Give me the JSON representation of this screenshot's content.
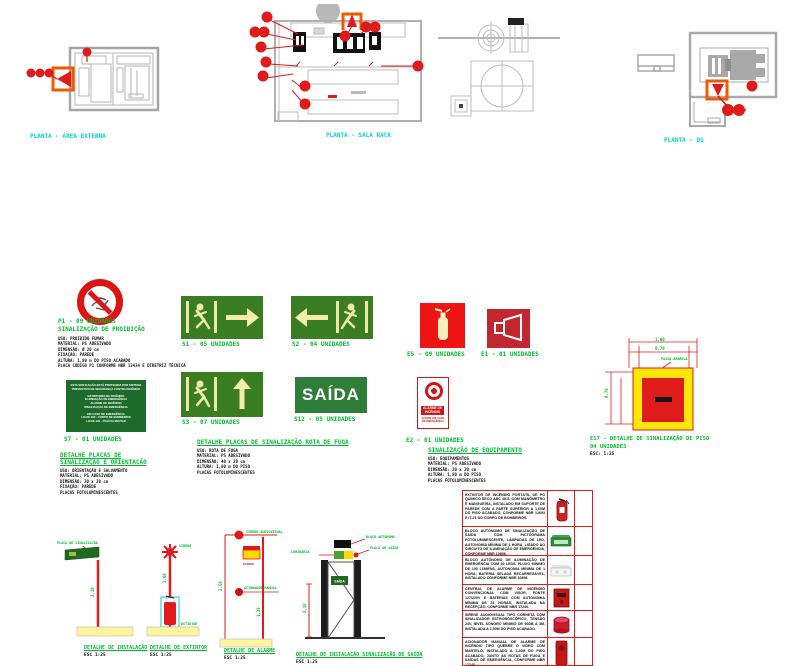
{
  "plans": {
    "left": {
      "label": "PLANTA - ÁREA EXTERNA"
    },
    "center": {
      "label": "PLANTA - SALA RACK"
    },
    "right": {
      "label": "PLANTA - DG"
    }
  },
  "prohibition": {
    "code": "P1 - 09 UNIDADES",
    "title": "SINALIZAÇÃO DE PROIBIÇÃO",
    "specs": [
      "USO: PROIBIDO FUMAR",
      "MATERIAL: PS ADESIVADO",
      "DIMENSÃO: Ø 20 cm",
      "FIXAÇÃO: PAREDE",
      "ALTURA: 1,80 m DO PISO ACABADO",
      "PLACA CÓDIGO P1 CONFORME NBR 13434 E DIRETRIZ TÉCNICA"
    ]
  },
  "signs": {
    "s1": "S1 - 05 UNIDADES",
    "s2": "S2 - 04 UNIDADES",
    "e5": "E5 - 09 UNIDADES",
    "e1": "E1 - 01 UNIDADES",
    "s7": "S7 - 01 UNIDADES",
    "s3": "S3 - 07 UNIDADES",
    "s12": "S12 - 05 UNIDADES",
    "e2": "E2 - 01 UNIDADES",
    "saida_text": "SAÍDA"
  },
  "s7_sign_lines": [
    "ESTA EDIFICAÇÃO ESTÁ PROTEGIDA POR SISTEMA",
    "PREVENTIVO DE SEGURANÇA CONTRA INCÊNDIO",
    "",
    "EXTINTORES DE INCÊNDIO",
    "ILUMINAÇÃO DE EMERGÊNCIA",
    "ALARME DE INCÊNDIO",
    "SINALIZAÇÃO DE EMERGÊNCIA",
    "",
    "EM CASO DE EMERGÊNCIA",
    "LIGUE 193 - CORPO DE BOMBEIROS",
    "LIGUE 190 - POLÍCIA MILITAR"
  ],
  "e2_sign": {
    "band1": "ALARME DE",
    "band2": "INCÊNDIO",
    "sub1": "ACIONE EM CASO",
    "sub2": "DE EMERGÊNCIA"
  },
  "blocks": {
    "orientation": {
      "title1": "DETALHE PLACAS DE",
      "title2": "SINALIZAÇÃO E ORIENTAÇÃO",
      "specs": [
        "USO: ORIENTAÇÃO E SALVAMENTO",
        "MATERIAL: PS ADESIVADO",
        "DIMENSÃO: 30 x 20 cm",
        "FIXAÇÃO: PAREDE",
        "PLACAS FOTOLUMINESCENTES"
      ]
    },
    "escape": {
      "title": "DETALHE PLACAS DE SINALIZAÇÃO ROTA DE FUGA",
      "specs": [
        "USO: ROTA DE FUGA",
        "MATERIAL: PS ADESIVADO",
        "DIMENSÃO: 40 x 20 cm",
        "ALTURA: 1,80 m DO PISO",
        "PLACAS FOTOLUMINESCENTES"
      ]
    },
    "equipment": {
      "title": "SINALIZAÇÃO DE EQUIPAMENTO",
      "specs": [
        "USO: EQUIPAMENTOS",
        "MATERIAL: PS ADESIVADO",
        "DIMENSÃO: 20 x 20 cm",
        "ALTURA: 1,80 m DO PISO",
        "PLACAS FOTOLUMINESCENTES"
      ]
    }
  },
  "e17": {
    "line1": "E17 - DETALHE DE SINALIZAÇÃO DE PISO",
    "line2": "04 UNIDADES",
    "scale": "ESC: 1:25",
    "leader": "FAIXA AMARELA",
    "dim_top": "1,00",
    "dim_top2": "0,70",
    "dim_left": "0,70"
  },
  "details": {
    "d1": {
      "title": "DETALHE DE INSTALAÇÃO",
      "scale": "ESC 1:25",
      "top_label": "PLACA DE SINALIZAÇÃO",
      "dim": "2,10"
    },
    "d2": {
      "title": "DETALHE DE EXTINTOR",
      "scale": "ESC 1:25",
      "top_label": "SIRENE",
      "side_label": "EXTINTOR",
      "dim": "1,60"
    },
    "d3": {
      "title": "DETALHE DE ALARME",
      "scale": "ESC 1:25",
      "top_label": "SIRENE AUDIOVISUAL",
      "mid_label": "STROBO",
      "low_label": "ACIONADOR MANUAL",
      "dim1": "2,50",
      "dim2": "1,20"
    },
    "d4": {
      "title": "DETALHE DE INSTALAÇÃO SINALIZAÇÃO DE SAÍDA",
      "scale": "ESC 1:25",
      "label_r1": "BLOCO AUTÔNOMO",
      "label_r2": "PLACA DE SAÍDA",
      "label_l": "LUMINÁRIA",
      "mini_sign": "SAÍDA",
      "dim": "2,10"
    }
  },
  "table": {
    "rows": [
      {
        "icon": "fire-extinguisher",
        "qty": "",
        "text": "EXTINTOR DE INCÊNDIO PORTÁTIL DE PÓ QUÍMICO SECO ABC 4KG, COM MANÔMETRO E MANGUEIRA, INSTALADO EM SUPORTE DE PAREDE COM A PARTE SUPERIOR A 1,60M DO PISO ACABADO, CONFORME NBR 12693 E IT-21 DO CORPO DE BOMBEIROS."
      },
      {
        "icon": "exit-luminaire",
        "qty": "",
        "text": "BLOCO AUTÔNOMO DE SINALIZAÇÃO DE SAÍDA COM PICTOGRAMA FOTOLUMINESCENTE, LÂMPADAS DE LED, AUTONOMIA MÍNIMA DE 1 HORA, LIGADO AO CIRCUITO DE ILUMINAÇÃO DE EMERGÊNCIA, CONFORME NBR 10898."
      },
      {
        "icon": "emergency-light",
        "qty": "",
        "text": "BLOCO AUTÔNOMO DE ILUMINAÇÃO DE EMERGÊNCIA COM 30 LEDS, FLUXO MÍNIMO DE 100 LÚMENS, AUTONOMIA MÍNIMA DE 1 HORA, BATERIA SELADA RECARREGÁVEL, INSTALADO CONFORME NBR 10898."
      },
      {
        "icon": "alarm-panel",
        "qty": "",
        "text": "CENTRAL DE ALARME DE INCÊNDIO CONVENCIONAL COM VISOR, FONTE 127/220V E BATERIAS COM AUTONOMIA MÍNIMA DE 24 HORAS, INSTALADA NA RECEPÇÃO, CONFORME NBR 17240."
      },
      {
        "icon": "siren",
        "qty": "",
        "text": "SIRENE AUDIOVISUAL TIPO CORNETA COM SINALIZADOR ESTROBOSCÓPICO, TENSÃO 24V, NÍVEL SONORO MÍNIMO DE 90DB A 3M, INSTALADA A 2,50M DO PISO ACABADO."
      },
      {
        "icon": "manual-call-point",
        "qty": "",
        "text": "ACIONADOR MANUAL DE ALARME DE INCÊNDIO TIPO QUEBRE O VIDRO COM MARTELO, INSTALADO A 1,20M DO PISO ACABADO, JUNTO ÀS ROTAS DE FUGA E SAÍDAS DE EMERGÊNCIA, CONFORME NBR 17240."
      }
    ]
  }
}
